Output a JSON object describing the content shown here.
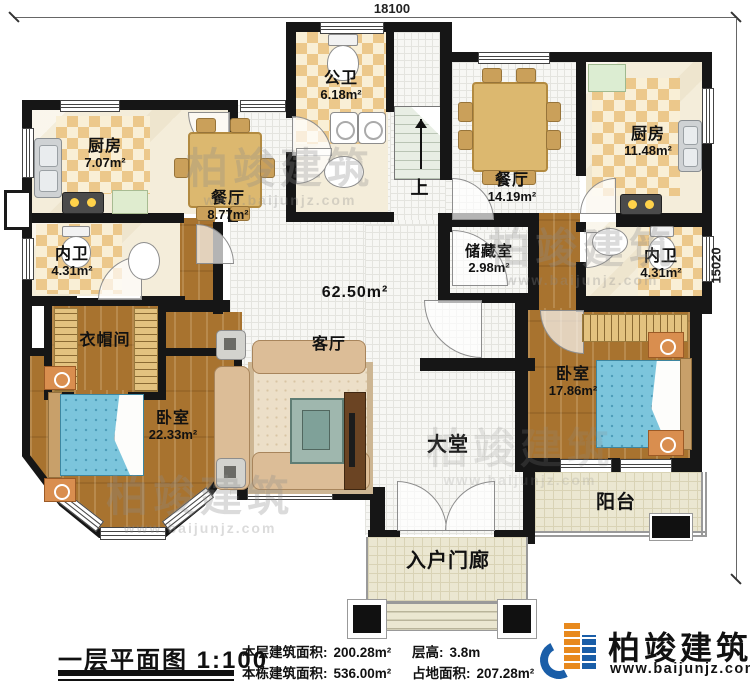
{
  "dimensions": {
    "top": "18100",
    "right": "15020"
  },
  "rooms": {
    "kitchen_left": {
      "name": "厨房",
      "area": "7.07m²"
    },
    "dining_left": {
      "name": "餐厅",
      "area": "8.77m²"
    },
    "public_bath": {
      "name": "公卫",
      "area": "6.18m²"
    },
    "stairs": {
      "name": "上"
    },
    "dining_right": {
      "name": "餐厅",
      "area": "14.19m²"
    },
    "kitchen_right": {
      "name": "厨房",
      "area": "11.48m²"
    },
    "inner_bath_left": {
      "name": "内卫",
      "area": "4.31m²"
    },
    "cloakroom": {
      "name": "衣帽间"
    },
    "living": {
      "name": "客厅",
      "area": "62.50m²"
    },
    "storage": {
      "name": "储藏室",
      "area": "2.98m²"
    },
    "inner_bath_right": {
      "name": "内卫",
      "area": "4.31m²"
    },
    "bedroom_left": {
      "name": "卧室",
      "area": "22.33m²"
    },
    "bedroom_right": {
      "name": "卧室",
      "area": "17.86m²"
    },
    "hall": {
      "name": "大堂"
    },
    "balcony": {
      "name": "阳台"
    },
    "porch": {
      "name": "入户门廊"
    }
  },
  "footer": {
    "plan_title": "一层平面图",
    "scale": "1:100",
    "stats": [
      {
        "label": "本层建筑面积:",
        "value": "200.28m²"
      },
      {
        "label": "本栋建筑面积:",
        "value": "536.00m²"
      },
      {
        "label": "层高:",
        "value": "3.8m"
      },
      {
        "label": "占地面积:",
        "value": "207.28m²"
      }
    ]
  },
  "brand": {
    "name": "柏竣建筑",
    "website": "www.baijunjz.com"
  },
  "watermark": {
    "text": "柏竣建筑",
    "sub": "www.baijunjz.com"
  },
  "colors": {
    "wall": "#161616",
    "checker_dark": "#ecc88b",
    "checker_light": "#f9efd6",
    "wood": "#a8732f",
    "tile": "#f7f7f4",
    "outdoor": "#ebe7d1",
    "brand_blue": "#1a5ea8",
    "brand_orange": "#e8891d",
    "bed": "#7cc5dc"
  }
}
